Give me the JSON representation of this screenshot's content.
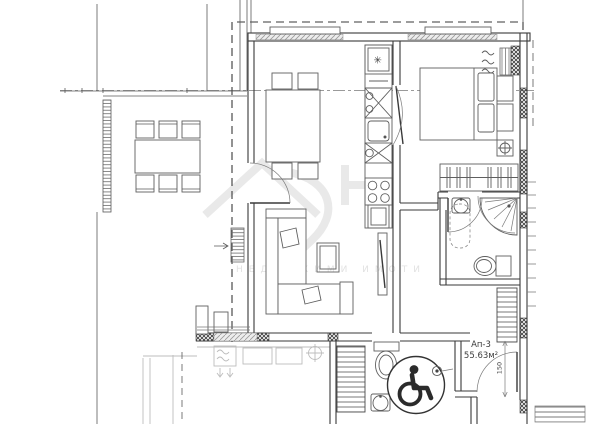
{
  "plan": {
    "apartment": {
      "label": "Ап-3",
      "area": "55.63м²"
    },
    "dimensions": {
      "entry_door_width": "150"
    },
    "symbols": {
      "freezer_star": "✳"
    },
    "watermark": {
      "text": "НЕДВИЖИМИ ИМОТИ"
    },
    "colors": {
      "line": "#3a3a3a",
      "wall_hatch": "#3d3d3d",
      "faint": "#bdbdbd",
      "watermark": "#e9e9e9",
      "background": "#ffffff"
    }
  }
}
